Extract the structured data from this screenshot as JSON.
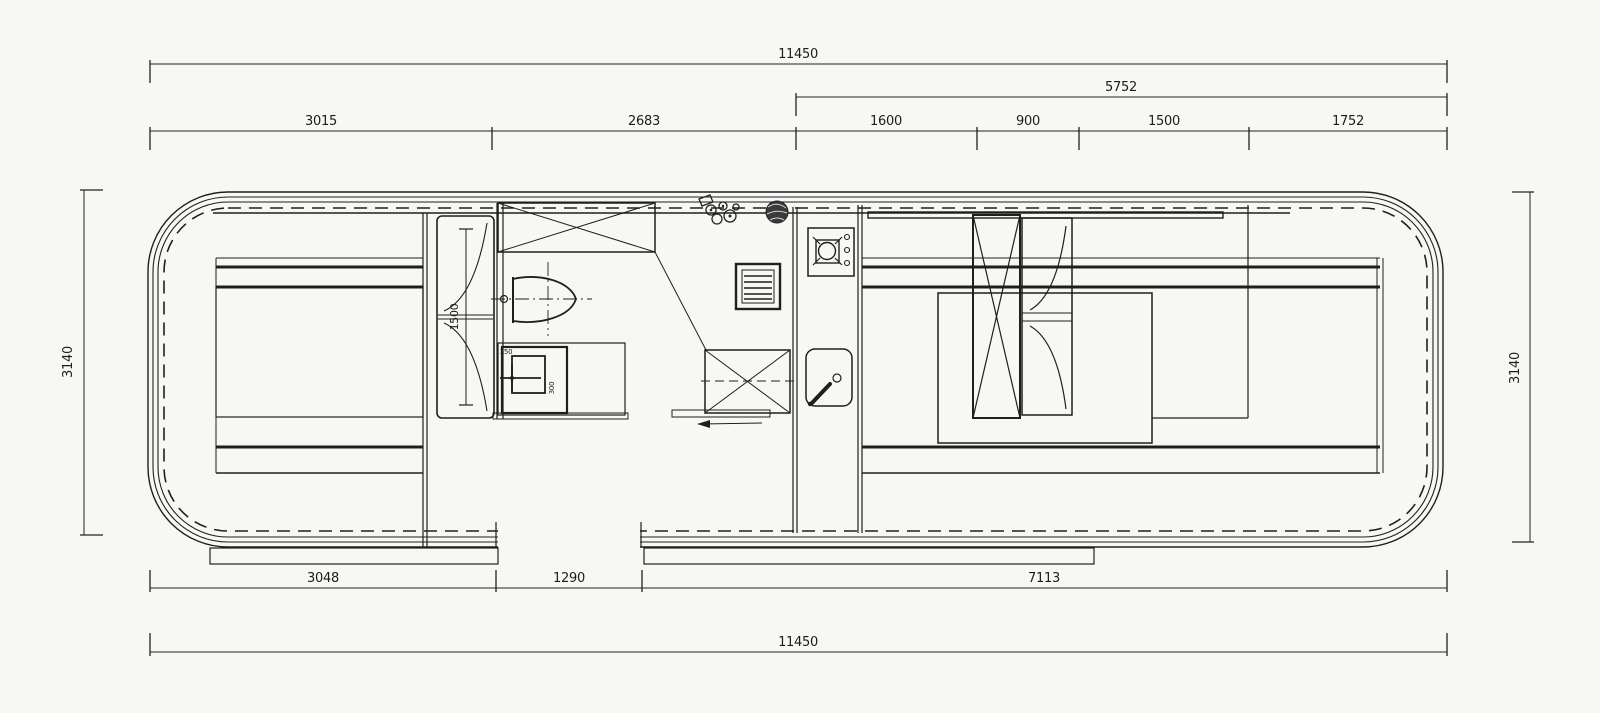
{
  "page": {
    "background": "#f7f7f4",
    "line_color": "#1f1f1f"
  },
  "dimensions": {
    "top_total": "11450",
    "top_group": "5752",
    "top_segments": [
      "3015",
      "2683",
      "1600",
      "900",
      "1500",
      "1752"
    ],
    "bottom_segments": [
      "3048",
      "1290",
      "7113"
    ],
    "bottom_total": "11450",
    "side_left": "3140",
    "side_right": "3140",
    "sofa_length": "1500",
    "basin_width": "350",
    "basin_depth": "300"
  },
  "fixtures": [
    "shower-tray",
    "toilet",
    "wash-basin-cabinet",
    "vent-grille",
    "folding-table",
    "cooktop",
    "kitchen-sink",
    "wardrobe",
    "bifold-cabinet",
    "double-bed",
    "bench-sofa",
    "plant"
  ]
}
